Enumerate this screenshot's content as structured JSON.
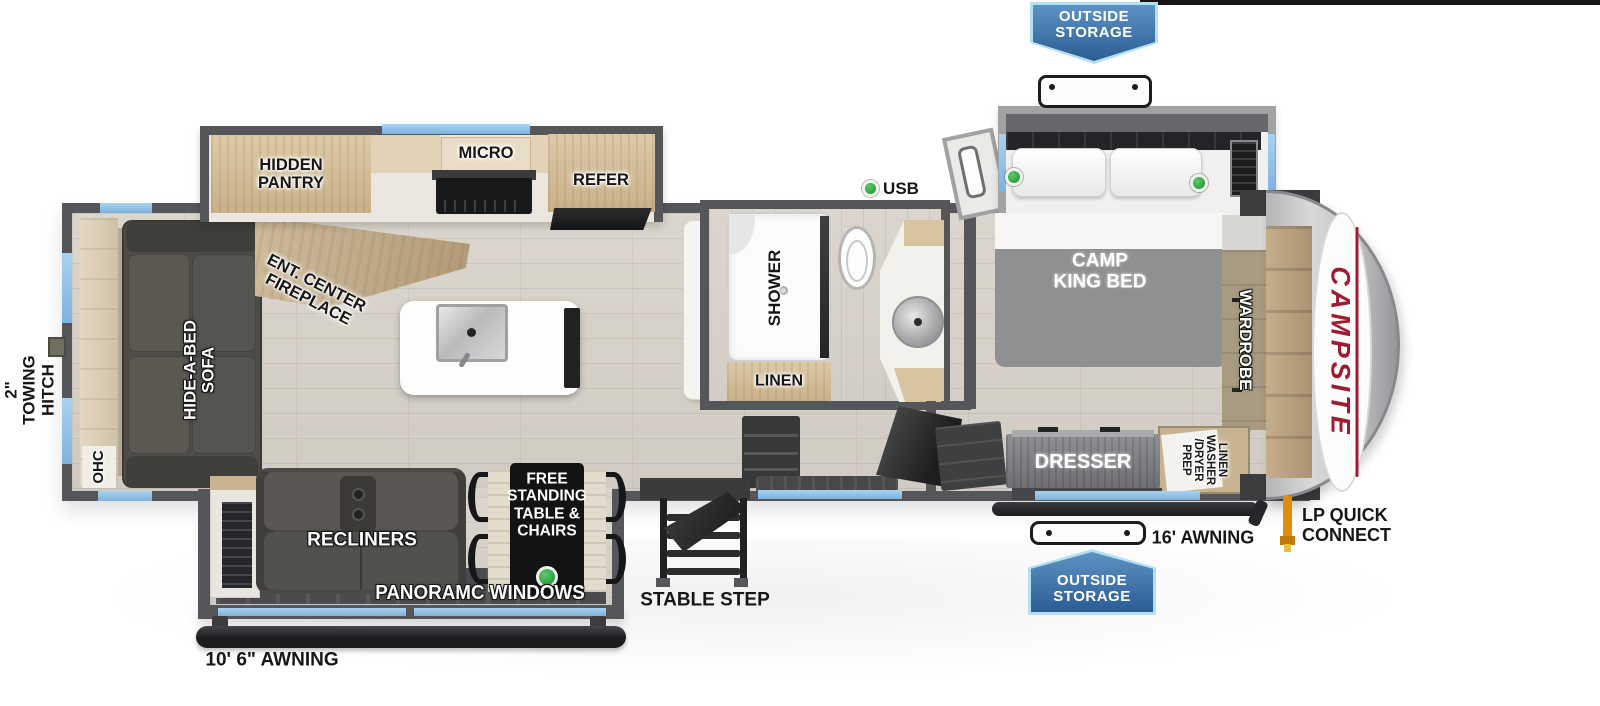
{
  "brand": {
    "name": "CAMPSITE"
  },
  "callouts": {
    "outside_storage_top": {
      "line1": "OUTSIDE",
      "line2": "STORAGE"
    },
    "outside_storage_bottom": {
      "line1": "OUTSIDE",
      "line2": "STORAGE"
    },
    "towing_hitch": {
      "line1": "2\"",
      "line2": "TOWING",
      "line3": "HITCH"
    },
    "rear_awning": "10' 6\" AWNING",
    "front_awning": "16' AWNING",
    "lp_quick_connect": {
      "line1": "LP QUICK",
      "line2": "CONNECT"
    },
    "stable_step": "STABLE STEP",
    "usb": "USB"
  },
  "living_room": {
    "ohc": "OHC",
    "hide_a_bed_sofa": {
      "line1": "HIDE-A-BED",
      "line2": "SOFA"
    },
    "ent_center_fireplace": {
      "line1": "ENT. CENTER",
      "line2": "FIREPLACE"
    },
    "recliners": "RECLINERS",
    "free_standing_table": {
      "line1": "FREE",
      "line2": "STANDING",
      "line3": "TABLE &",
      "line4": "CHAIRS"
    },
    "panoramic_windows": "PANORAMC WINDOWS"
  },
  "kitchen": {
    "hidden_pantry": {
      "line1": "HIDDEN",
      "line2": "PANTRY"
    },
    "micro": "MICRO",
    "refer": "REFER"
  },
  "bathroom": {
    "shower": "SHOWER",
    "linen": "LINEN"
  },
  "bedroom": {
    "camp_king_bed": {
      "line1": "CAMP",
      "line2": "KING BED"
    },
    "wardrobe": "WARDROBE",
    "dresser": "DRESSER",
    "washer_dryer_prep": {
      "line1": "LINEN",
      "line2": "WASHER",
      "line3": "/DRYER",
      "line4": "PREP"
    }
  },
  "colors": {
    "wall_gray": "#55565a",
    "window_blue": "#8fc1e9",
    "badge_blue": "#2d5f95",
    "badge_border": "#b3e1f0",
    "accent_green": "#34a94a",
    "brand_red": "#9e1b32",
    "lp_orange": "#df8c10",
    "floor_tan": "#d6d1c8",
    "cabinet_wood": "#d3bd99"
  }
}
